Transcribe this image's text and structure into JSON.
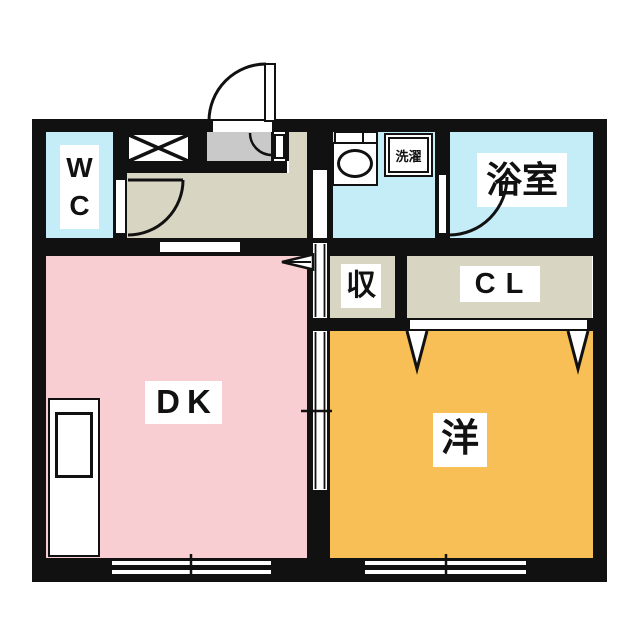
{
  "plan": {
    "type": "apartment-floor-plan",
    "rooms": {
      "wc": {
        "label": "WC",
        "color": "#c5edf8"
      },
      "bathroom": {
        "label": "浴室",
        "color": "#c5edf8"
      },
      "washroom": {
        "color": "#c5edf8"
      },
      "laundry": {
        "label": "洗濯"
      },
      "storage": {
        "label": "収",
        "color": "#d9d5c3"
      },
      "closet": {
        "label": "CL",
        "color": "#d9d5c3"
      },
      "dining_kitchen": {
        "label": "DK",
        "color": "#f9ced3"
      },
      "western_room": {
        "label": "洋",
        "color": "#f7bf55"
      },
      "hallway": {
        "color": "#d9d5c3"
      },
      "entrance": {
        "color": "#c9c9c9"
      }
    },
    "colors": {
      "wall": "#111111",
      "background": "#ffffff",
      "fixture": "#ffffff"
    }
  }
}
